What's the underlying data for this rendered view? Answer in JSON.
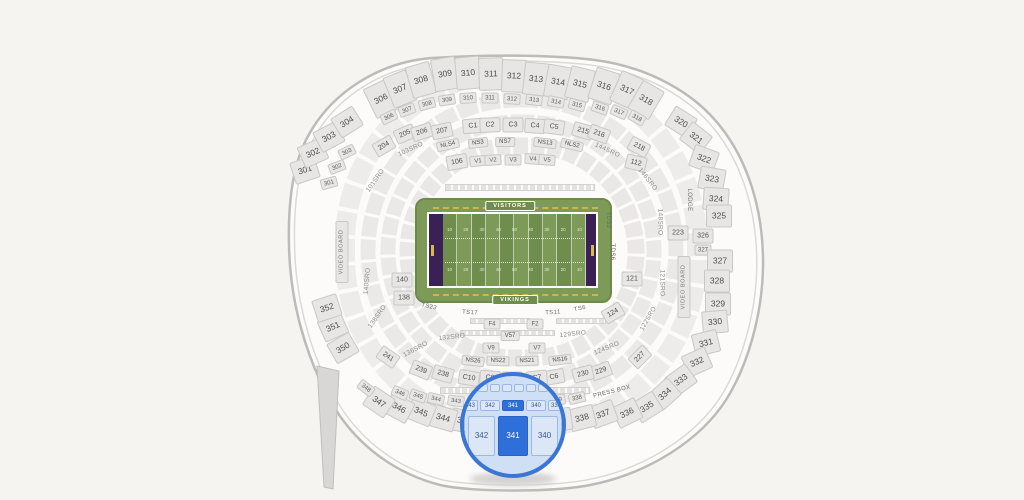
{
  "palette": {
    "bg": "#f5f4f1",
    "section_fill": "#e7e6e4",
    "section_border": "#c9c8c6",
    "section_label": "#4f4f4f",
    "shell_stroke": "#bcbbb9",
    "field_green": "#7d9a58",
    "field_green_dark": "#6f8d4c",
    "endzone_purple": "#3a2055",
    "yellow_accent": "#d9b94a",
    "lens_border": "#3a76d6",
    "lens_fill": "#cfe0f6",
    "highlight_blue": "#2e6fd9",
    "lens_box_fill": "#dbe6f6",
    "lens_box_border": "#9cb8e2",
    "lens_box_text": "#3c5a8c"
  },
  "field": {
    "visitors_label": "VISITORS",
    "vikings_label": "VIKINGS",
    "yard_numbers": [
      "10",
      "20",
      "30",
      "40",
      "50",
      "40",
      "30",
      "20",
      "10"
    ]
  },
  "magnifier": {
    "sections": [
      "343",
      "342",
      "341",
      "340",
      "339"
    ],
    "highlighted": "341"
  },
  "sections": [
    {
      "t": "306",
      "x": 381,
      "y": 99,
      "c": "lg",
      "r": -26
    },
    {
      "t": "307",
      "x": 400,
      "y": 89,
      "c": "lg",
      "r": -22
    },
    {
      "t": "308",
      "x": 421,
      "y": 80,
      "c": "lg",
      "r": -16
    },
    {
      "t": "309",
      "x": 445,
      "y": 74,
      "c": "lg",
      "r": -10
    },
    {
      "t": "310",
      "x": 468,
      "y": 73,
      "c": "lg",
      "r": -5
    },
    {
      "t": "311",
      "x": 491,
      "y": 74,
      "c": "lg",
      "r": -2
    },
    {
      "t": "312",
      "x": 514,
      "y": 76,
      "c": "lg",
      "r": 2
    },
    {
      "t": "313",
      "x": 536,
      "y": 79,
      "c": "lg",
      "r": 6
    },
    {
      "t": "314",
      "x": 558,
      "y": 82,
      "c": "lg",
      "r": 10
    },
    {
      "t": "315",
      "x": 580,
      "y": 84,
      "c": "lg",
      "r": 14
    },
    {
      "t": "316",
      "x": 604,
      "y": 86,
      "c": "lg",
      "r": 18
    },
    {
      "t": "317",
      "x": 627,
      "y": 90,
      "c": "lg",
      "r": 24
    },
    {
      "t": "318",
      "x": 646,
      "y": 100,
      "c": "lg",
      "r": 30
    },
    {
      "t": "301",
      "x": 305,
      "y": 170,
      "c": "lg2",
      "r": -18
    },
    {
      "t": "302",
      "x": 313,
      "y": 153,
      "c": "lg2",
      "r": -24
    },
    {
      "t": "303",
      "x": 329,
      "y": 137,
      "c": "lg2",
      "r": -28
    },
    {
      "t": "304",
      "x": 347,
      "y": 122,
      "c": "lg2",
      "r": -32
    },
    {
      "t": "320",
      "x": 681,
      "y": 122,
      "c": "lg2",
      "r": 32
    },
    {
      "t": "321",
      "x": 696,
      "y": 138,
      "c": "lg2",
      "r": 38
    },
    {
      "t": "322",
      "x": 704,
      "y": 159,
      "c": "lg2",
      "r": 20
    },
    {
      "t": "323",
      "x": 712,
      "y": 179,
      "c": "lg2",
      "r": 10
    },
    {
      "t": "324",
      "x": 716,
      "y": 199,
      "c": "lg2",
      "r": 4
    },
    {
      "t": "325",
      "x": 719,
      "y": 216,
      "c": "lg2",
      "r": 0
    },
    {
      "t": "326",
      "x": 703,
      "y": 236,
      "c": "md",
      "r": 0
    },
    {
      "t": "327",
      "x": 703,
      "y": 250,
      "c": "sm",
      "r": 0
    },
    {
      "t": "327",
      "x": 720,
      "y": 261,
      "c": "lg2",
      "r": 0
    },
    {
      "t": "328",
      "x": 717,
      "y": 281,
      "c": "lg2",
      "r": 0
    },
    {
      "t": "329",
      "x": 718,
      "y": 304,
      "c": "lg2",
      "r": 0
    },
    {
      "t": "330",
      "x": 715,
      "y": 322,
      "c": "lg2",
      "r": -5
    },
    {
      "t": "331",
      "x": 706,
      "y": 343,
      "c": "lg2",
      "r": -14
    },
    {
      "t": "332",
      "x": 697,
      "y": 362,
      "c": "lg2",
      "r": -24
    },
    {
      "t": "333",
      "x": 681,
      "y": 380,
      "c": "lg2",
      "r": -36
    },
    {
      "t": "334",
      "x": 665,
      "y": 394,
      "c": "lg2",
      "r": -42
    },
    {
      "t": "335",
      "x": 647,
      "y": 407,
      "c": "lg2",
      "r": -32
    },
    {
      "t": "336",
      "x": 627,
      "y": 413,
      "c": "lg2",
      "r": -26
    },
    {
      "t": "337",
      "x": 603,
      "y": 414,
      "c": "lg2",
      "r": -20
    },
    {
      "t": "338",
      "x": 582,
      "y": 418,
      "c": "lg2",
      "r": -14
    },
    {
      "t": "339",
      "x": 559,
      "y": 420,
      "c": "lg2",
      "r": -9
    },
    {
      "t": "343",
      "x": 464,
      "y": 421,
      "c": "lg2",
      "r": 10
    },
    {
      "t": "344",
      "x": 443,
      "y": 418,
      "c": "lg2",
      "r": 16
    },
    {
      "t": "345",
      "x": 421,
      "y": 412,
      "c": "lg2",
      "r": 22
    },
    {
      "t": "346",
      "x": 399,
      "y": 408,
      "c": "lg2",
      "r": 28
    },
    {
      "t": "347",
      "x": 379,
      "y": 402,
      "c": "lg2",
      "r": 34
    },
    {
      "t": "350",
      "x": 343,
      "y": 348,
      "c": "lg2",
      "r": -30
    },
    {
      "t": "351",
      "x": 333,
      "y": 327,
      "c": "lg2",
      "r": -24
    },
    {
      "t": "352",
      "x": 327,
      "y": 308,
      "c": "lg2",
      "r": -18
    },
    {
      "t": "301",
      "x": 329,
      "y": 183,
      "c": "sm",
      "r": -15
    },
    {
      "t": "302",
      "x": 337,
      "y": 167,
      "c": "sm",
      "r": -21
    },
    {
      "t": "303",
      "x": 347,
      "y": 152,
      "c": "sm",
      "r": -26
    },
    {
      "t": "306",
      "x": 389,
      "y": 117,
      "c": "sm",
      "r": -26
    },
    {
      "t": "307",
      "x": 407,
      "y": 110,
      "c": "sm",
      "r": -21
    },
    {
      "t": "308",
      "x": 427,
      "y": 104,
      "c": "sm",
      "r": -15
    },
    {
      "t": "309",
      "x": 447,
      "y": 100,
      "c": "sm",
      "r": -9
    },
    {
      "t": "310",
      "x": 468,
      "y": 98,
      "c": "sm",
      "r": -4
    },
    {
      "t": "311",
      "x": 490,
      "y": 98,
      "c": "sm",
      "r": 0
    },
    {
      "t": "312",
      "x": 512,
      "y": 99,
      "c": "sm",
      "r": 3
    },
    {
      "t": "313",
      "x": 534,
      "y": 100,
      "c": "sm",
      "r": 7
    },
    {
      "t": "314",
      "x": 556,
      "y": 102,
      "c": "sm",
      "r": 11
    },
    {
      "t": "315",
      "x": 577,
      "y": 105,
      "c": "sm",
      "r": 15
    },
    {
      "t": "316",
      "x": 600,
      "y": 108,
      "c": "sm",
      "r": 19
    },
    {
      "t": "317",
      "x": 619,
      "y": 112,
      "c": "sm",
      "r": 24
    },
    {
      "t": "318",
      "x": 637,
      "y": 118,
      "c": "sm",
      "r": 29
    },
    {
      "t": "204",
      "x": 384,
      "y": 146,
      "c": "md",
      "r": -30
    },
    {
      "t": "205",
      "x": 405,
      "y": 134,
      "c": "md",
      "r": -24
    },
    {
      "t": "206",
      "x": 422,
      "y": 132,
      "c": "md",
      "r": -18
    },
    {
      "t": "207",
      "x": 442,
      "y": 131,
      "c": "md",
      "r": -12
    },
    {
      "t": "C1",
      "x": 473,
      "y": 126,
      "c": "md",
      "r": -5
    },
    {
      "t": "C2",
      "x": 490,
      "y": 125,
      "c": "md",
      "r": -2
    },
    {
      "t": "C3",
      "x": 513,
      "y": 125,
      "c": "md",
      "r": 0
    },
    {
      "t": "C4",
      "x": 535,
      "y": 126,
      "c": "md",
      "r": 4
    },
    {
      "t": "C5",
      "x": 554,
      "y": 127,
      "c": "md",
      "r": 8
    },
    {
      "t": "215",
      "x": 583,
      "y": 131,
      "c": "md",
      "r": 16
    },
    {
      "t": "216",
      "x": 599,
      "y": 134,
      "c": "md",
      "r": 20
    },
    {
      "t": "218",
      "x": 639,
      "y": 147,
      "c": "md",
      "r": 28
    },
    {
      "t": "223",
      "x": 678,
      "y": 233,
      "c": "md",
      "r": 0
    },
    {
      "t": "227",
      "x": 640,
      "y": 357,
      "c": "md",
      "r": -45
    },
    {
      "t": "229",
      "x": 601,
      "y": 371,
      "c": "md",
      "r": -20
    },
    {
      "t": "230",
      "x": 583,
      "y": 374,
      "c": "md",
      "r": -14
    },
    {
      "t": "C6",
      "x": 554,
      "y": 377,
      "c": "md",
      "r": -10
    },
    {
      "t": "C7",
      "x": 537,
      "y": 378,
      "c": "md",
      "r": -6
    },
    {
      "t": "C8",
      "x": 512,
      "y": 379,
      "c": "md",
      "r": 0
    },
    {
      "t": "C9",
      "x": 490,
      "y": 378,
      "c": "md",
      "r": 5
    },
    {
      "t": "C10",
      "x": 469,
      "y": 378,
      "c": "md",
      "r": 9
    },
    {
      "t": "238",
      "x": 443,
      "y": 374,
      "c": "md",
      "r": 16
    },
    {
      "t": "239",
      "x": 421,
      "y": 370,
      "c": "md",
      "r": 22
    },
    {
      "t": "241",
      "x": 388,
      "y": 357,
      "c": "md",
      "r": 35
    },
    {
      "t": "NLS4",
      "x": 448,
      "y": 145,
      "c": "tag",
      "r": -13
    },
    {
      "t": "NS3",
      "x": 478,
      "y": 143,
      "c": "tag",
      "r": -7
    },
    {
      "t": "NS7",
      "x": 505,
      "y": 142,
      "c": "tag",
      "r": 0
    },
    {
      "t": "NS13",
      "x": 545,
      "y": 143,
      "c": "tag",
      "r": 7
    },
    {
      "t": "NLS2",
      "x": 572,
      "y": 145,
      "c": "tag",
      "r": 13
    },
    {
      "t": "NS26",
      "x": 473,
      "y": 361,
      "c": "tag",
      "r": 6
    },
    {
      "t": "NS22",
      "x": 498,
      "y": 361,
      "c": "tag",
      "r": 2
    },
    {
      "t": "NS21",
      "x": 527,
      "y": 361,
      "c": "tag",
      "r": -2
    },
    {
      "t": "NS16",
      "x": 560,
      "y": 360,
      "c": "tag",
      "r": -7
    },
    {
      "t": "106",
      "x": 457,
      "y": 162,
      "c": "md",
      "r": -10
    },
    {
      "t": "112",
      "x": 636,
      "y": 163,
      "c": "md",
      "r": 14
    },
    {
      "t": "V1",
      "x": 478,
      "y": 161,
      "c": "sm",
      "r": -6
    },
    {
      "t": "V2",
      "x": 493,
      "y": 160,
      "c": "sm",
      "r": -3
    },
    {
      "t": "V3",
      "x": 513,
      "y": 160,
      "c": "sm",
      "r": 0
    },
    {
      "t": "V4",
      "x": 533,
      "y": 159,
      "c": "sm",
      "r": 3
    },
    {
      "t": "V5",
      "x": 547,
      "y": 160,
      "c": "sm",
      "r": 5
    },
    {
      "t": "140",
      "x": 402,
      "y": 280,
      "c": "md",
      "r": 0
    },
    {
      "t": "138",
      "x": 404,
      "y": 298,
      "c": "md",
      "r": 0
    },
    {
      "t": "121",
      "x": 632,
      "y": 279,
      "c": "md",
      "r": 0
    },
    {
      "t": "124",
      "x": 613,
      "y": 313,
      "c": "md",
      "r": -30
    },
    {
      "t": "F4",
      "x": 492,
      "y": 324,
      "c": "sm",
      "r": 0
    },
    {
      "t": "F2",
      "x": 535,
      "y": 324,
      "c": "sm",
      "r": 0
    },
    {
      "t": "V57",
      "x": 510,
      "y": 336,
      "c": "tag",
      "r": 0
    },
    {
      "t": "V9",
      "x": 491,
      "y": 348,
      "c": "sm",
      "r": 0
    },
    {
      "t": "V7",
      "x": 537,
      "y": 348,
      "c": "sm",
      "r": 0
    },
    {
      "t": "348",
      "x": 366,
      "y": 388,
      "c": "sm",
      "r": 38
    },
    {
      "t": "346",
      "x": 400,
      "y": 393,
      "c": "sm",
      "r": 24
    },
    {
      "t": "345",
      "x": 418,
      "y": 396,
      "c": "sm",
      "r": 19
    },
    {
      "t": "344",
      "x": 436,
      "y": 399,
      "c": "sm",
      "r": 13
    },
    {
      "t": "343",
      "x": 456,
      "y": 401,
      "c": "sm",
      "r": 8
    },
    {
      "t": "339",
      "x": 557,
      "y": 400,
      "c": "sm",
      "r": -8
    },
    {
      "t": "338",
      "x": 577,
      "y": 398,
      "c": "sm",
      "r": -13
    },
    {
      "t": "TS23",
      "x": 429,
      "y": 307,
      "c": "txt",
      "r": 12
    },
    {
      "t": "TS17",
      "x": 470,
      "y": 313,
      "c": "txt",
      "r": 4
    },
    {
      "t": "TS11",
      "x": 553,
      "y": 313,
      "c": "txt",
      "r": -4
    },
    {
      "t": "TS6",
      "x": 580,
      "y": 309,
      "c": "txt",
      "r": -12
    },
    {
      "t": "TDS2",
      "x": 608,
      "y": 220,
      "c": "txt",
      "r": 90
    },
    {
      "t": "TDS6",
      "x": 612,
      "y": 252,
      "c": "txt",
      "r": 90
    },
    {
      "t": "103SRO",
      "x": 411,
      "y": 150,
      "c": "sro",
      "r": -25
    },
    {
      "t": "101SRO",
      "x": 376,
      "y": 181,
      "c": "sro",
      "r": -55
    },
    {
      "t": "144SRO",
      "x": 607,
      "y": 151,
      "c": "sro",
      "r": 25
    },
    {
      "t": "146SRO",
      "x": 647,
      "y": 180,
      "c": "sro",
      "r": 52
    },
    {
      "t": "148SRO",
      "x": 659,
      "y": 222,
      "c": "sro",
      "r": 90
    },
    {
      "t": "121SRO",
      "x": 661,
      "y": 283,
      "c": "sro",
      "r": 90
    },
    {
      "t": "140SRO",
      "x": 368,
      "y": 281,
      "c": "sro",
      "r": -85
    },
    {
      "t": "138SRO",
      "x": 378,
      "y": 317,
      "c": "sro",
      "r": -55
    },
    {
      "t": "136SRO",
      "x": 416,
      "y": 350,
      "c": "sro",
      "r": -28
    },
    {
      "t": "132SRO",
      "x": 452,
      "y": 338,
      "c": "sro",
      "r": -6
    },
    {
      "t": "129SRO",
      "x": 573,
      "y": 335,
      "c": "sro",
      "r": -6
    },
    {
      "t": "124SRO",
      "x": 607,
      "y": 349,
      "c": "sro",
      "r": -22
    },
    {
      "t": "122SRO",
      "x": 649,
      "y": 319,
      "c": "sro",
      "r": -60
    },
    {
      "t": "LODGE",
      "x": 689,
      "y": 200,
      "c": "txt",
      "r": 90
    },
    {
      "t": "PRESS BOX",
      "x": 612,
      "y": 392,
      "c": "txt",
      "r": -14
    },
    {
      "t": "VIDEO BOARD",
      "x": 342,
      "y": 252,
      "c": "vb",
      "r": -90
    },
    {
      "t": "VIDEO BOARD",
      "x": 684,
      "y": 287,
      "c": "vb",
      "r": -90
    }
  ]
}
